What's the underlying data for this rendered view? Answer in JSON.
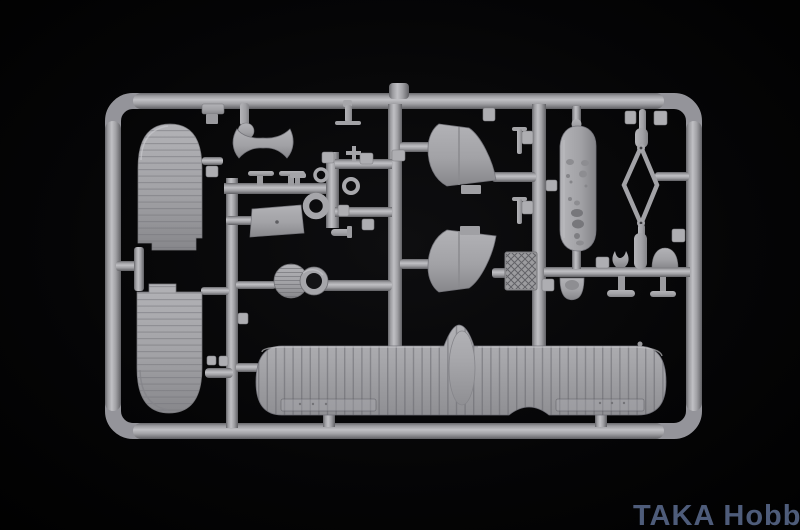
{
  "scene": {
    "description": "Photograph of a light-gray injection-molded plastic model kit sprue (biplane seaplane parts) lying on a black background",
    "background_color": "#000000",
    "plastic_color": "#a4a4a8",
    "plastic_highlight": "#c2c2c6",
    "plastic_shadow": "#6a6a6e"
  },
  "watermark": {
    "text": "TAKA Hobby",
    "color": "#4e5c7a"
  },
  "parts": [
    "upper-pontoon-float",
    "lower-pontoon-float",
    "lower-wing-with-center-fairing",
    "fuselage-half",
    "upper-tail-fin",
    "lower-tail-fin",
    "engine-cowling-disc",
    "cowling-ring",
    "diamond-rigging-frame",
    "checkered-radiator",
    "cockpit-seat",
    "headrest-dome",
    "cabane-struts",
    "control-rings",
    "small-fittings"
  ]
}
